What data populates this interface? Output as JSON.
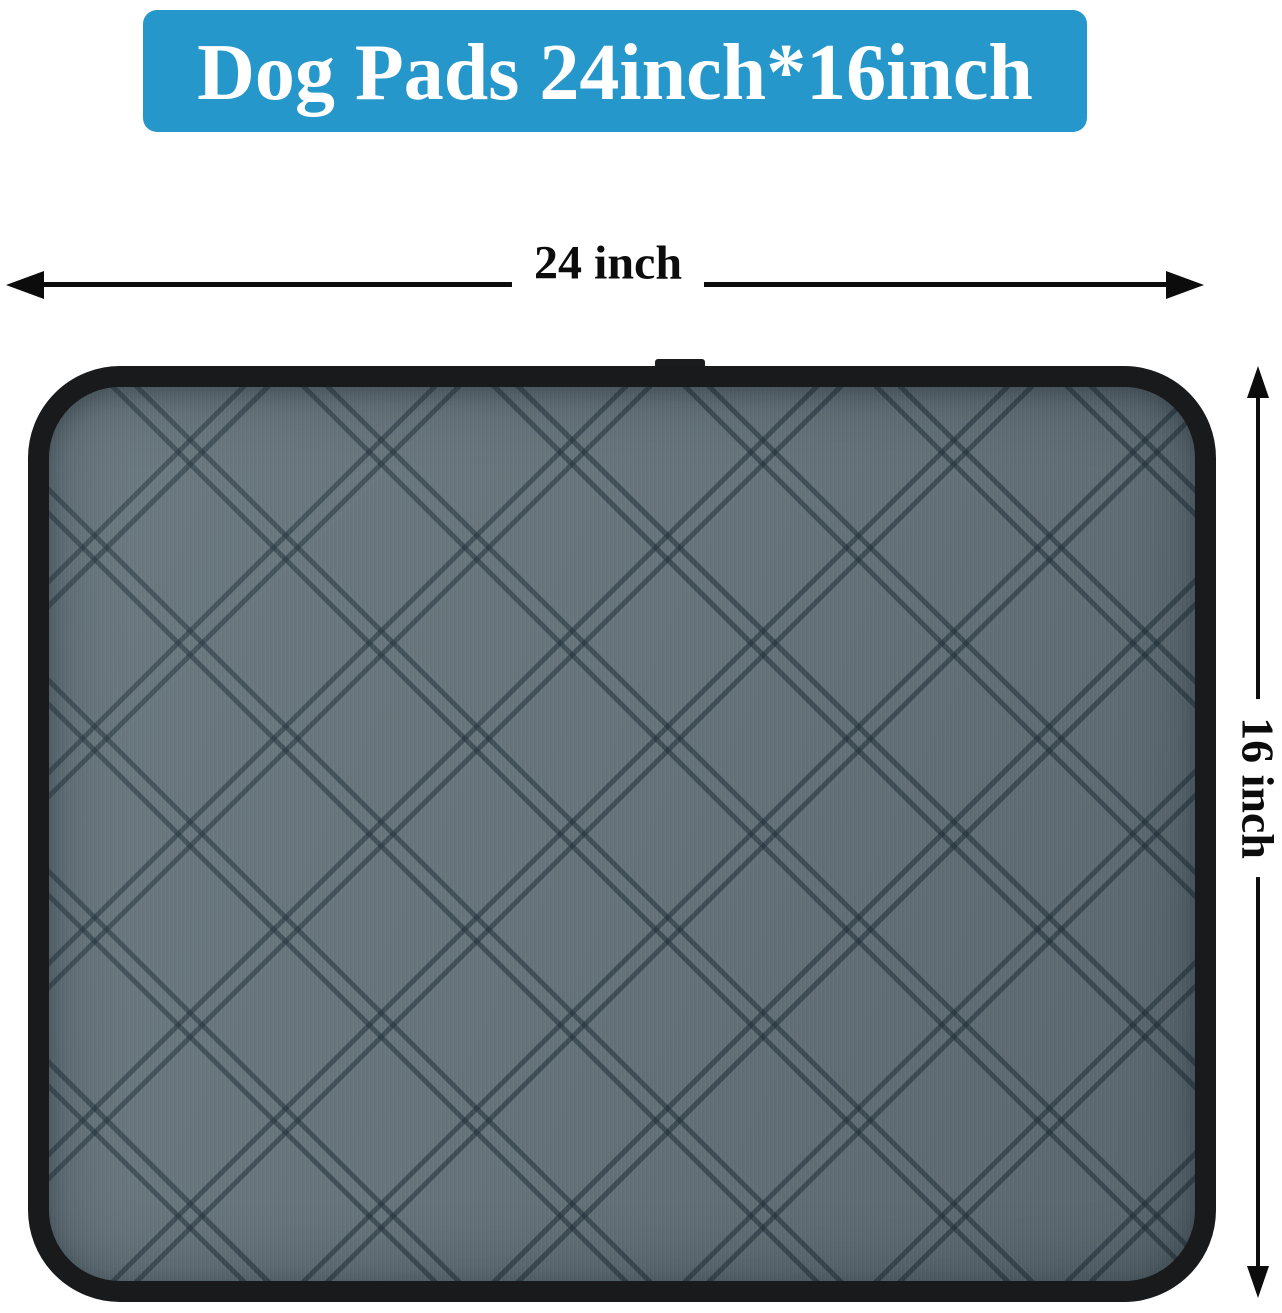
{
  "banner": {
    "label": "Dog Pads 24inch*16inch",
    "bg_color": "#2697cb",
    "text_color": "#ffffff"
  },
  "dimension_labels": {
    "width": "24 inch",
    "height": "16 inch"
  },
  "product": {
    "name": "washable quilted dog pee pad",
    "fabric_color": "#66747b",
    "stitch_color": "#39464e",
    "trim_color": "#181a1c"
  },
  "annotation": {
    "arrow_color": "#0c0c0c"
  },
  "page": {
    "background_color": "#ffffff"
  }
}
